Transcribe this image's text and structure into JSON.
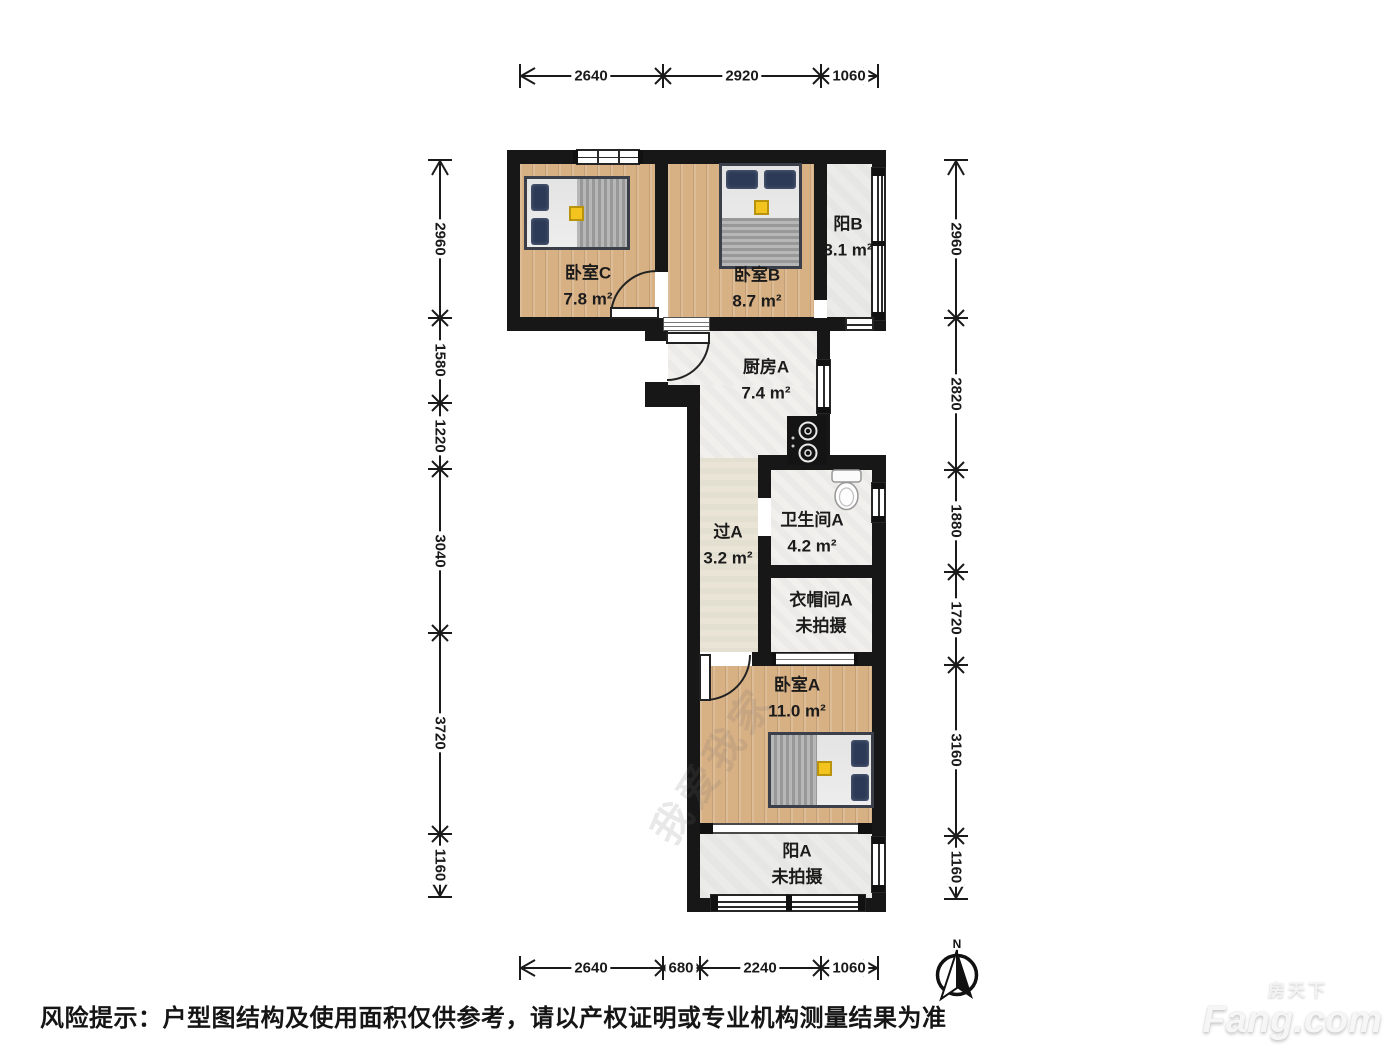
{
  "page": {
    "background": "#ffffff"
  },
  "floorplan": {
    "rooms": {
      "bedroomC": {
        "name": "卧室C",
        "area": "7.8 m²"
      },
      "bedroomB": {
        "name": "卧室B",
        "area": "8.7 m²"
      },
      "balconyB": {
        "name": "阳B",
        "area": "3.1 m²"
      },
      "kitchenA": {
        "name": "厨房A",
        "area": "7.4 m²"
      },
      "hallwayA": {
        "name": "过A",
        "area": "3.2 m²"
      },
      "bathroomA": {
        "name": "卫生间A",
        "area": "4.2 m²"
      },
      "cloakroomA": {
        "name": "衣帽间A",
        "area": "未拍摄"
      },
      "bedroomA": {
        "name": "卧室A",
        "area": "11.0 m²"
      },
      "balconyA": {
        "name": "阳A",
        "area": "未拍摄"
      }
    },
    "dimensions_mm": {
      "top": [
        "2640",
        "2920",
        "1060"
      ],
      "bottom": [
        "2640",
        "680",
        "2240",
        "1060"
      ],
      "left": [
        "2960",
        "1580",
        "1220",
        "3040",
        "3720",
        "1160"
      ],
      "right": [
        "2960",
        "2820",
        "1880",
        "1720",
        "3160",
        "1160"
      ]
    },
    "compass_label": "N",
    "watermark": "我爱我家"
  },
  "footer": {
    "disclaimer": "风险提示：户型图结构及使用面积仅供参考，请以产权证明或专业机构测量结果为准"
  },
  "branding": {
    "logo_cn": "房天下",
    "logo_en": "Fang.com"
  },
  "colors": {
    "wall": "#171717",
    "wood_floor": "#d7b084",
    "tile_floor": "#f1f0ed",
    "balcony_floor": "#ebebe9",
    "hall_floor": "#e9e4d5",
    "accent_yellow": "#f3c41d",
    "pillow_navy": "#2c3a57",
    "blanket_gray": "#a8a8a8"
  }
}
